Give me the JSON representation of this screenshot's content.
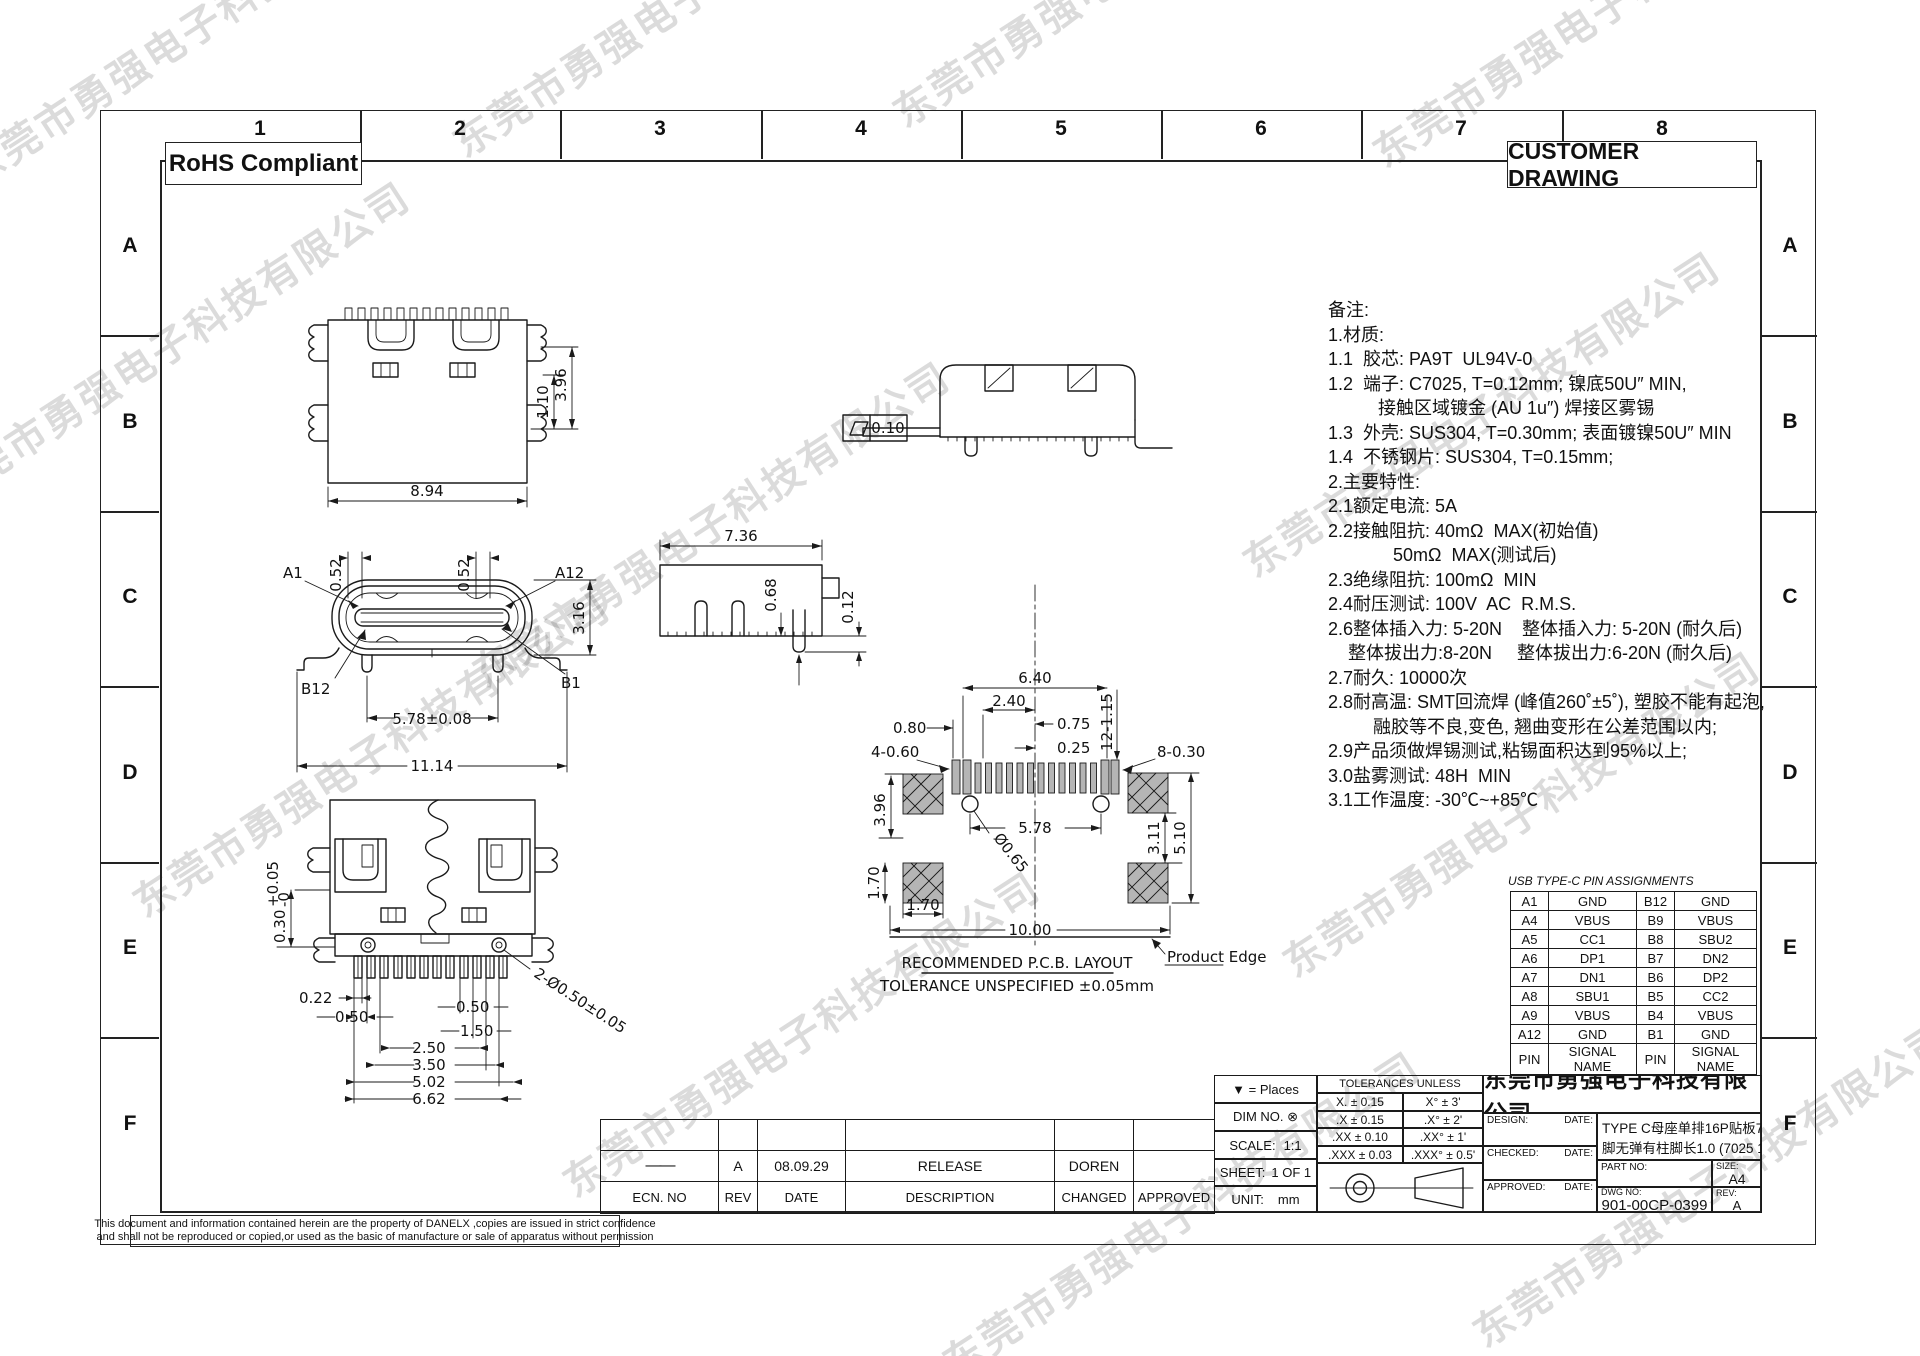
{
  "page": {
    "watermark": "东莞市勇强电子科技有限公司",
    "rohs_label": "RoHS Compliant",
    "customer_drawing_label": "CUSTOMER DRAWING",
    "grid_cols": [
      "1",
      "2",
      "3",
      "4",
      "5",
      "6",
      "7",
      "8"
    ],
    "grid_rows": [
      "A",
      "B",
      "C",
      "D",
      "E",
      "F"
    ]
  },
  "notes": {
    "lines": [
      "备注:",
      "1.材质:",
      "1.1  胶芯: PA9T  UL94V-0",
      "1.2  端子: C7025, T=0.12mm; 镍底50U″ MIN,",
      "          接触区域镀金 (AU 1u″) 焊接区雾锡",
      "1.3  外壳: SUS304, T=0.30mm; 表面镀镍50U″ MIN",
      "1.4  不锈钢片: SUS304, T=0.15mm;",
      "2.主要特性:",
      "2.1额定电流: 5A",
      "2.2接触阻抗: 40mΩ  MAX(初始值)",
      "             50mΩ  MAX(测试后)",
      "2.3绝缘阻抗: 100mΩ  MIN",
      "2.4耐压测试: 100V  AC  R.M.S.",
      "2.6整体插入力: 5-20N    整体插入力: 5-20N (耐久后)",
      "    整体拔出力:8-20N     整体拔出力:6-20N (耐久后)",
      "2.7耐久: 10000次",
      "2.8耐高温: SMT回流焊 (峰值260˚±5˚), 塑胶不能有起泡,",
      "         融胶等不良,变色, 翘曲变形在公差范围以内;",
      "2.9产品须做焊锡测试,粘锡面积达到95%以上;",
      "3.0盐雾测试: 48H  MIN",
      "3.1工作温度: -30℃~+85℃"
    ]
  },
  "pin_table": {
    "title": "USB TYPE-C PIN ASSIGNMENTS",
    "rows": [
      [
        "A1",
        "GND",
        "B12",
        "GND"
      ],
      [
        "A4",
        "VBUS",
        "B9",
        "VBUS"
      ],
      [
        "A5",
        "CC1",
        "B8",
        "SBU2"
      ],
      [
        "A6",
        "DP1",
        "B7",
        "DN2"
      ],
      [
        "A7",
        "DN1",
        "B6",
        "DP2"
      ],
      [
        "A8",
        "SBU1",
        "B5",
        "CC2"
      ],
      [
        "A9",
        "VBUS",
        "B4",
        "VBUS"
      ],
      [
        "A12",
        "GND",
        "B1",
        "GND"
      ],
      [
        "PIN",
        "SIGNAL NAME",
        "PIN",
        "SIGNAL NAME"
      ]
    ]
  },
  "revision_table": {
    "row": {
      "ecn": "——",
      "rev": "A",
      "date": "08.09.29",
      "description": "RELEASE",
      "changed": "DOREN",
      "approved": ""
    },
    "header": [
      "ECN. NO",
      "REV",
      "DATE",
      "DESCRIPTION",
      "CHANGED",
      "APPROVED"
    ]
  },
  "title_block": {
    "places": "▼ =   Places",
    "dim_no": "DIM NO. ⊗",
    "scale_label": "SCALE:",
    "scale": "1:1",
    "sheet_label": "SHEET:",
    "sheet": "1 OF 1",
    "unit_label": "UNIT:",
    "unit": "mm",
    "tol_header": "TOLERANCES UNLESS",
    "tol_rows": [
      [
        "X.  ±  0.15",
        "X°   ±  3'"
      ],
      [
        ".X  ±  0.15",
        ".X°  ±  2'"
      ],
      [
        ".XX ±  0.10",
        ".XX° ±  1'"
      ],
      [
        ".XXX ±  0.03",
        ".XXX° ± 0.5'"
      ]
    ],
    "company": "东莞市勇强电子科技有限公司",
    "design_label": "DESIGN:",
    "checked_label": "CHECKED:",
    "approved_label": "APPROVED:",
    "date_label": "DATE:",
    "product_line1": "TYPE C母座单排16P贴板7.35长四",
    "product_line2": "脚无弹有柱脚长1.0 (7025 1U)",
    "part_no_label": "PART NO:",
    "size_label": "SIZE:",
    "size": "A4",
    "dwg_no_label": "DWG NO:",
    "dwg_no": "901-00CP-0399",
    "rev_label": "REV:",
    "rev": "A"
  },
  "disclaimer": {
    "line1": "This document and information contained herein are the property of DANELX ,copies are issued in strict confidence",
    "line2": "and shall not be reproduced or copied,or used as the basic of manufacture or sale of apparatus without permission"
  },
  "views": {
    "top": {
      "dim_width": "8.94",
      "dim_h1": "1.10",
      "dim_h2": "3.96"
    },
    "side_a": {
      "flatness": "0.10"
    },
    "front": {
      "a1": "A1",
      "a12": "A12",
      "b12": "B12",
      "b1": "B1",
      "d052a": "0.52",
      "d052b": "0.52",
      "d316": "3.16",
      "d578": "5.78±0.08",
      "d1114": "11.14"
    },
    "side_b": {
      "d736": "7.36",
      "d068": "0.68",
      "d012": "0.12"
    },
    "pcb": {
      "title": "RECOMMENDED   P.C.B. LAYOUT",
      "tolerance": "TOLERANCE UNSPECIFIED ±0.05mm",
      "product_edge": "Product Edge",
      "d640": "6.40",
      "d240": "2.40",
      "d075": "0.75",
      "d025": "0.25",
      "d080": "0.80",
      "d4060": "4-0.60",
      "d12115": "12-1.15",
      "d8030": "8-0.30",
      "d578": "5.78",
      "d065": "Ø0.65",
      "d396": "3.96",
      "d170v": "1.70",
      "d170h": "1.70",
      "d1000": "10.00",
      "d311": "3.11",
      "d510": "5.10"
    },
    "bottom": {
      "d030": "0.30",
      "d030t": "+0.05",
      "d030b": "-0",
      "d022": "0.22",
      "d050l": "0.50",
      "d050r": "0.50",
      "d150": "1.50",
      "d250": "2.50",
      "d350": "3.50",
      "d502": "5.02",
      "d662": "6.62",
      "dhole": "2-Ø0.50±0.05"
    }
  }
}
